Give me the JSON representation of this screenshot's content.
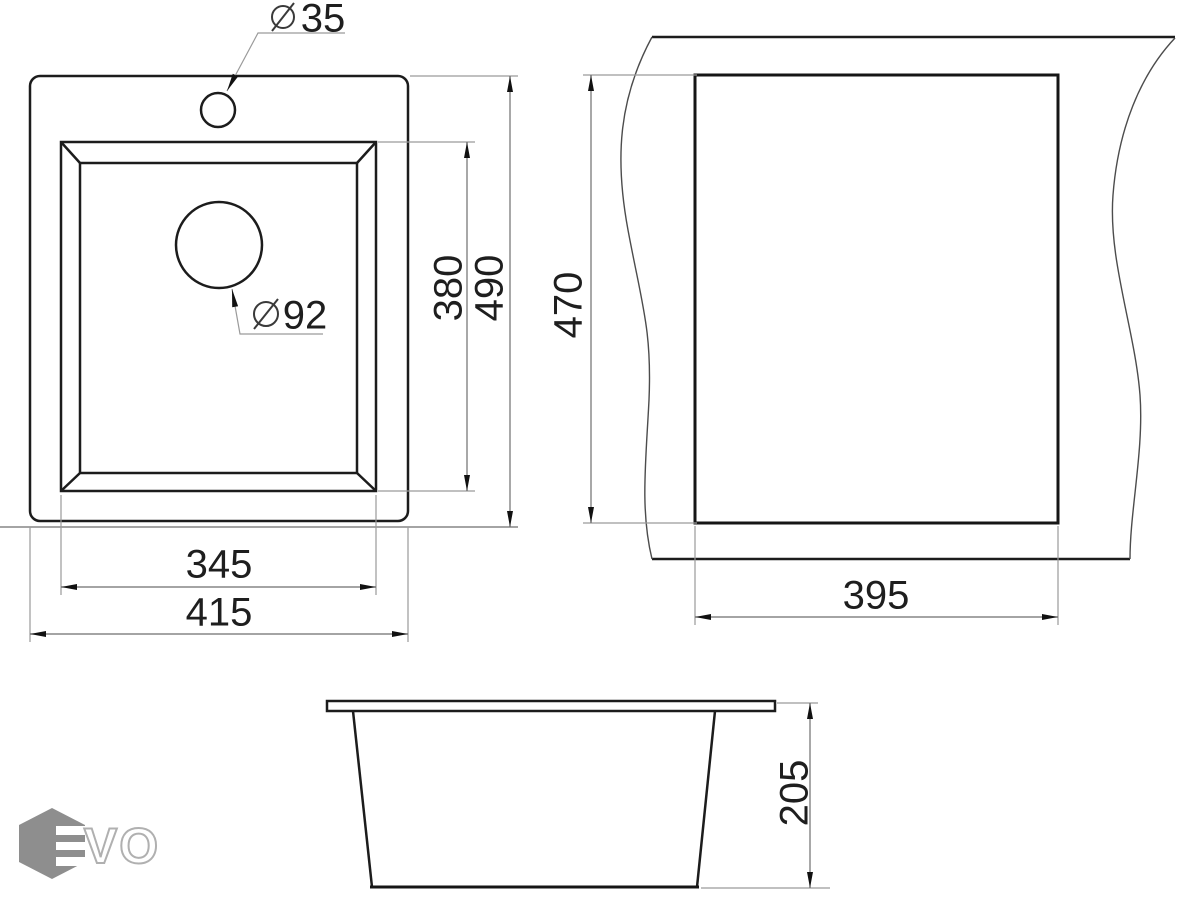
{
  "drawing": {
    "type": "kitchen sink installation dimension drawing",
    "views": {
      "plan_view": "sink top view with faucet hole and drain hole",
      "cutout_view": "countertop cutout with break lines",
      "side_view": "sink cross-section profile"
    }
  },
  "dims": {
    "faucet_hole": {
      "symbol": "diameter",
      "value": "35"
    },
    "drain_hole": {
      "symbol": "diameter",
      "value": "92"
    },
    "bowl_length": "380",
    "overall_length": "490",
    "bowl_width": "345",
    "overall_width": "415",
    "cutout_length": "470",
    "cutout_width": "395",
    "depth": "205"
  },
  "logo": {
    "text": "VO",
    "mark": "hexagon-e"
  },
  "icons": {
    "diameter_symbol": "slashed-circle-icon",
    "logo_mark": "hexagon-e-icon"
  },
  "colors": {
    "object_line": "#1c1c1c",
    "dimension_line": "#6e6e6e",
    "extension_line": "#9a9a9a",
    "text": "#1e1e1e",
    "logo_gray": "#8e8e8e",
    "logo_outline": "#b0b0b0",
    "background": "#ffffff"
  }
}
